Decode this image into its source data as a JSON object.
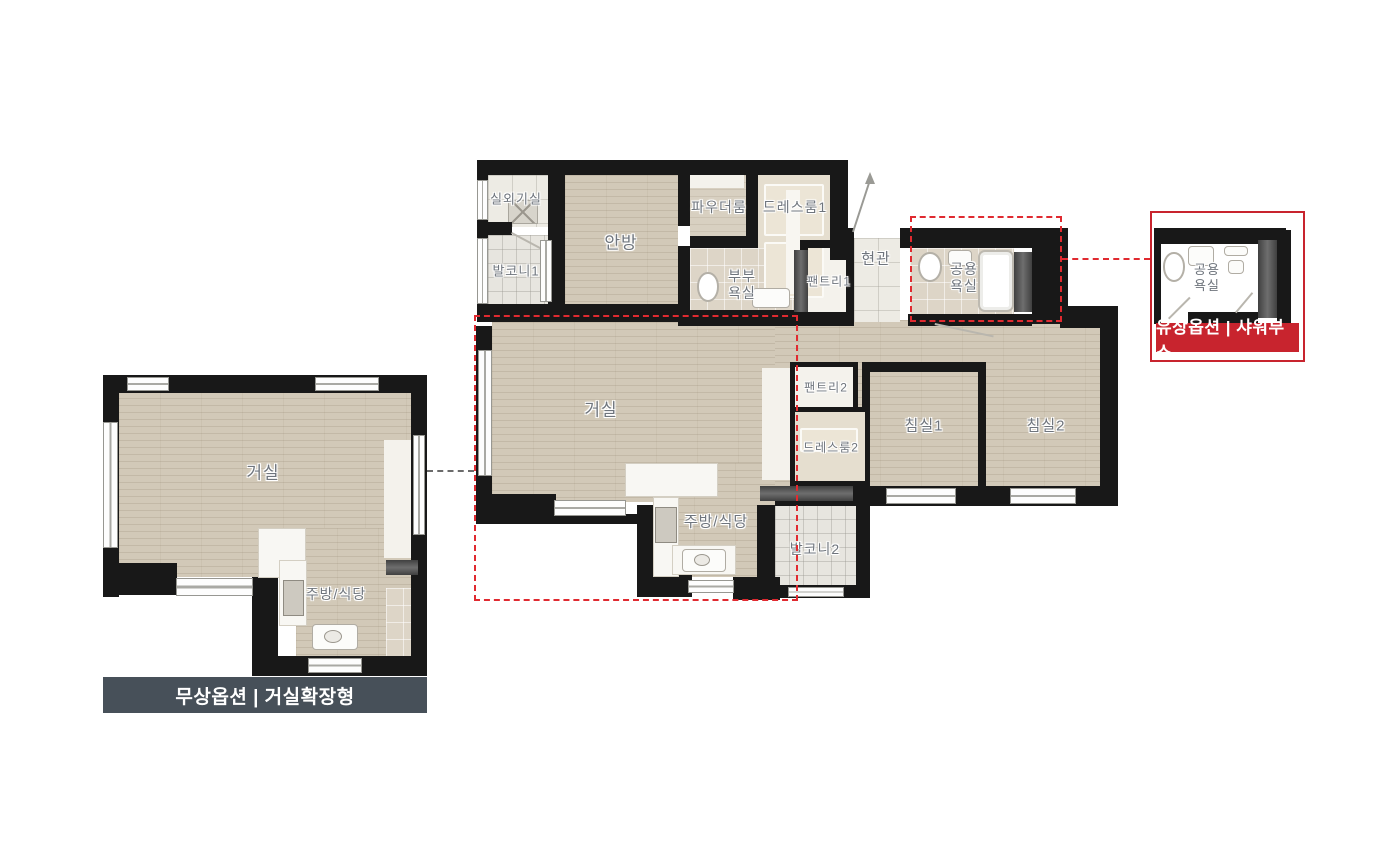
{
  "colors": {
    "option_red": "#c8242e",
    "red_dashed": "#e02a30",
    "caption_slate": "#475059",
    "wall_black": "#181818",
    "wood_floor": "#d2c9b8",
    "label_gray": "#6f757d"
  },
  "main_plan": {
    "rooms": {
      "outdoor_unit": "실외기실",
      "balcony1": "발코니1",
      "master_bedroom": "안방",
      "powder_room": "파우더룸",
      "dressroom1": "드레스룸1",
      "master_bath_l1": "부부",
      "master_bath_l2": "욕실",
      "pantry1": "팬트리1",
      "entrance": "현관",
      "common_bath_l1": "공용",
      "common_bath_l2": "욕실",
      "living": "거실",
      "pantry2": "팬트리2",
      "dressroom2": "드레스룸2",
      "bedroom1": "침실1",
      "bedroom2": "침실2",
      "kitchen": "주방/식당",
      "balcony2": "발코니2"
    }
  },
  "insets": {
    "living_extension": {
      "living": "거실",
      "kitchen": "주방/식당",
      "caption": "무상옵션 | 거실확장형"
    },
    "shower": {
      "bath_l1": "공용",
      "bath_l2": "욕실",
      "caption": "유상옵션 | 샤워부스"
    }
  }
}
